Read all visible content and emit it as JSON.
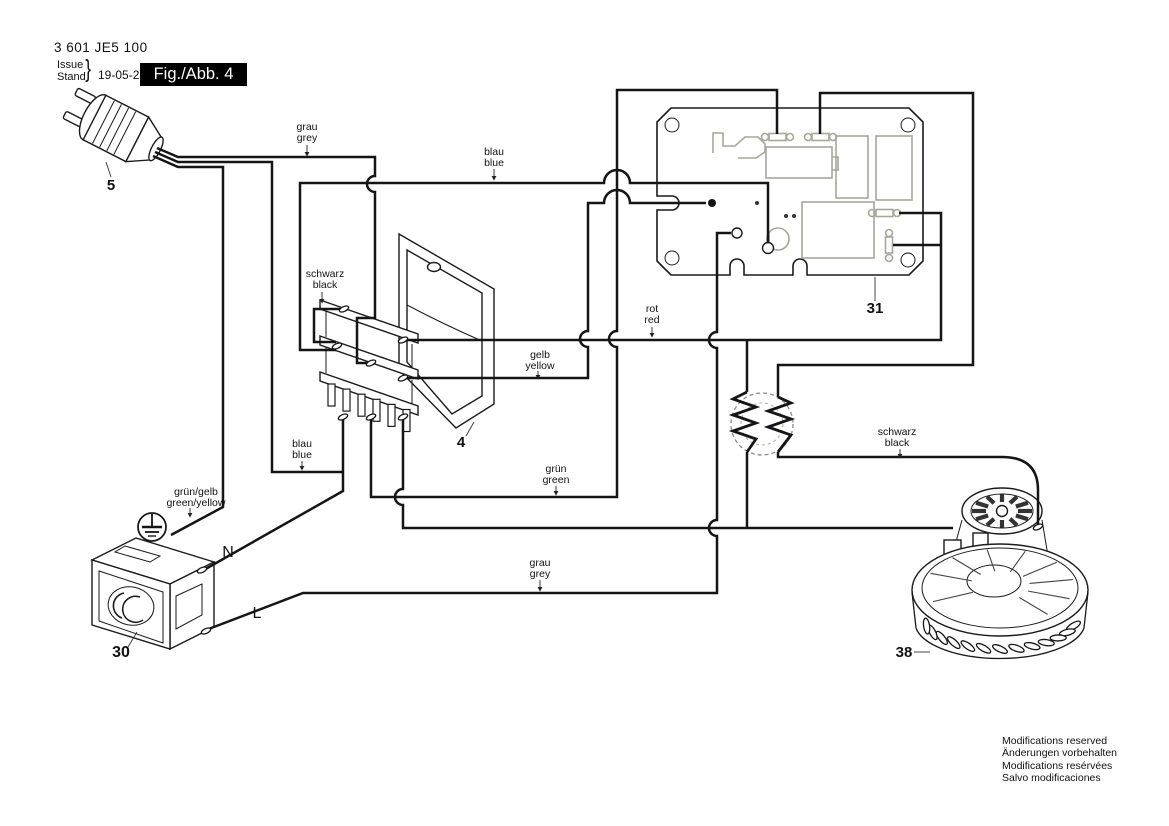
{
  "header": {
    "part_number": "3 601 JE5 100",
    "issue_en": "Issue",
    "issue_de": "Stand",
    "brace": "}",
    "date": "19-05-29",
    "figure_label": "Fig./Abb. 4"
  },
  "wire_labels": {
    "grau_top": {
      "de": "grau",
      "en": "grey"
    },
    "blau_top": {
      "de": "blau",
      "en": "blue"
    },
    "schwarz_switch": {
      "de": "schwarz",
      "en": "black"
    },
    "gelb": {
      "de": "gelb",
      "en": "yellow"
    },
    "rot": {
      "de": "rot",
      "en": "red"
    },
    "gruen": {
      "de": "grün",
      "en": "green"
    },
    "blau_bottom": {
      "de": "blau",
      "en": "blue"
    },
    "gruen_gelb": {
      "de": "grün/gelb",
      "en": "green/yellow"
    },
    "grau_bottom": {
      "de": "grau",
      "en": "grey"
    },
    "schwarz_motor": {
      "de": "schwarz",
      "en": "black"
    }
  },
  "terminals": {
    "neutral": "N",
    "line": "L"
  },
  "parts": {
    "plug": "5",
    "switch": "4",
    "pcb": "31",
    "socket": "30",
    "motor": "38"
  },
  "footer": {
    "lines": [
      "Modifications reserved",
      "Änderungen vorbehalten",
      "Modifications resérvées",
      "Salvo modificaciones"
    ]
  },
  "colors": {
    "ink": "#151515",
    "pcb_detail": "#a6a69a",
    "choke_ring": "#8a8a8a"
  }
}
